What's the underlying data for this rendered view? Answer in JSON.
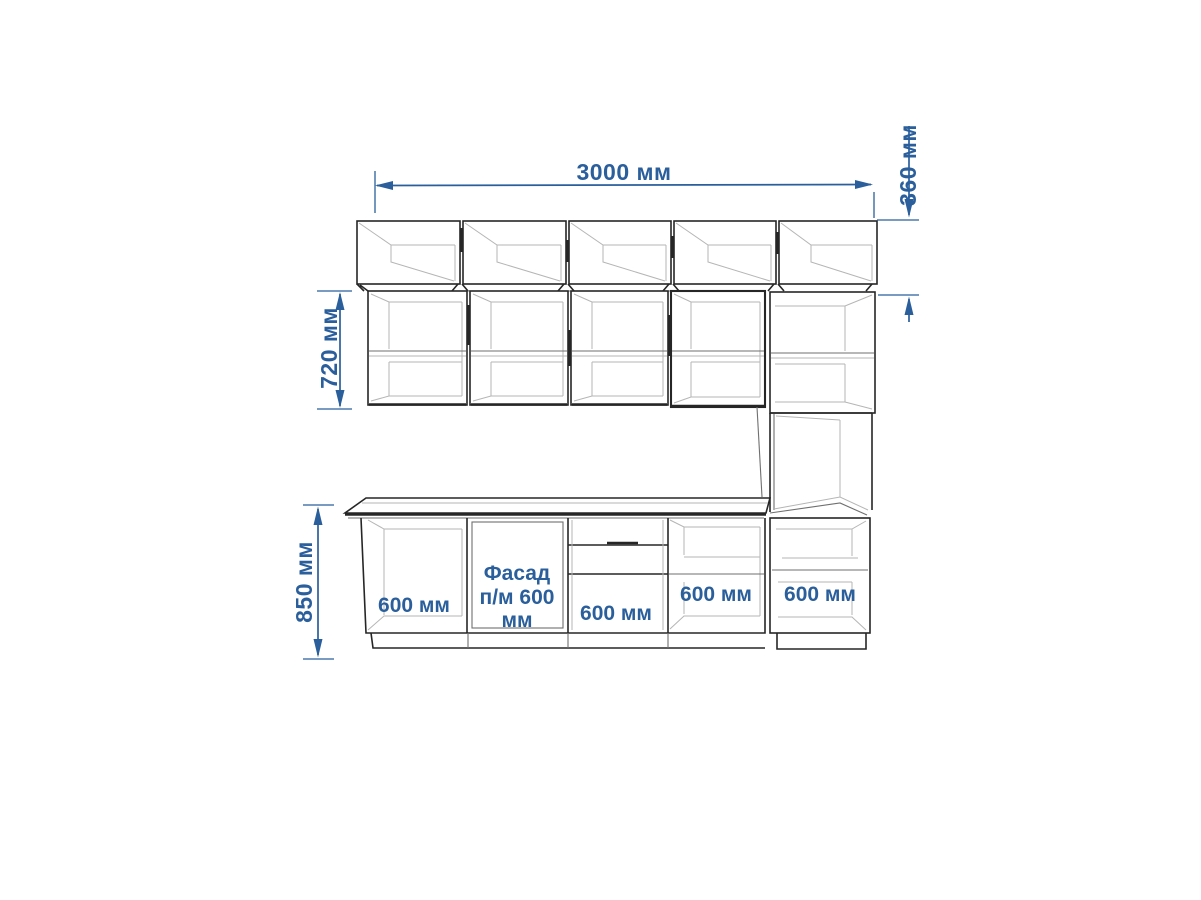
{
  "colors": {
    "dimension": "#2a5f9c",
    "line_dark": "#262626",
    "line_medium": "#6f6f6f",
    "line_light": "#b5b5b5",
    "background": "#ffffff"
  },
  "dimensions": {
    "total_width": "3000 мм",
    "top_cabinet_height": "360 мм",
    "wall_cabinet_height": "720 мм",
    "base_cabinet_height": "850 мм"
  },
  "base_labels": {
    "section_1": "600 мм",
    "section_2_line_1": "Фасад",
    "section_2_line_2": "п/м 600",
    "section_2_line_3": "мм",
    "section_3": "600 мм",
    "section_4": "600 мм",
    "tall_column": "600 мм"
  }
}
